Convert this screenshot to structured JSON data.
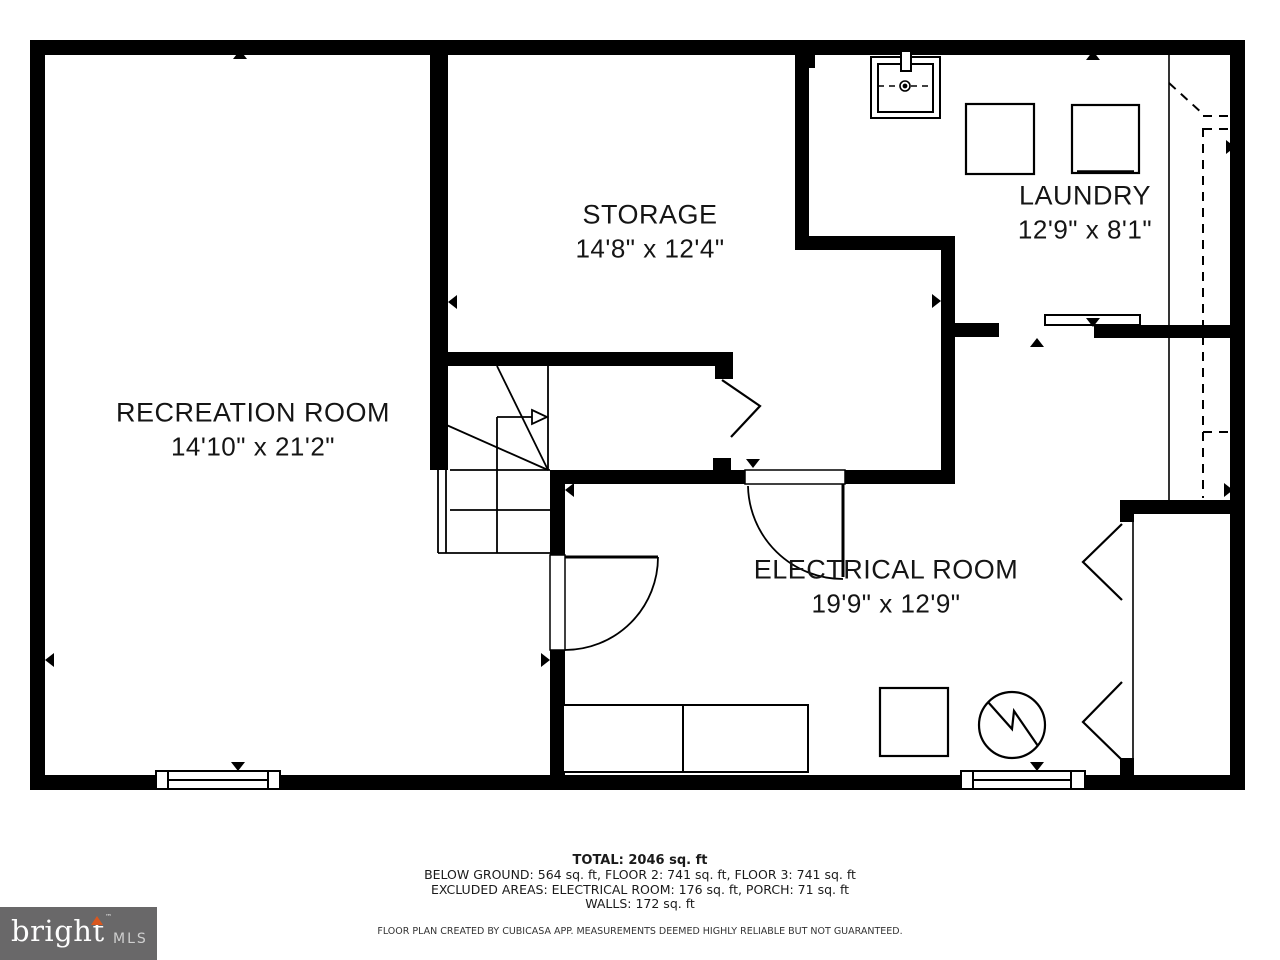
{
  "plan": {
    "rooms": [
      {
        "name": "RECREATION ROOM",
        "dims": "14'10\" x 21'2\""
      },
      {
        "name": "STORAGE",
        "dims": "14'8\" x 12'4\""
      },
      {
        "name": "LAUNDRY",
        "dims": "12'9\" x 8'1\""
      },
      {
        "name": "ELECTRICAL ROOM",
        "dims": "19'9\" x 12'9\""
      }
    ],
    "fixtures": [
      "sink",
      "washer",
      "dryer",
      "water-heater",
      "electrical-panel",
      "counter",
      "stairs"
    ]
  },
  "summary": {
    "total": "TOTAL: 2046 sq. ft",
    "line1": "BELOW GROUND: 564 sq. ft, FLOOR 2: 741 sq. ft, FLOOR 3: 741 sq. ft",
    "line2": "EXCLUDED AREAS: ELECTRICAL ROOM: 176 sq. ft, PORCH: 71 sq. ft",
    "line3": "WALLS: 172 sq. ft"
  },
  "disclaimer": "FLOOR PLAN CREATED BY CUBICASA APP. MEASUREMENTS DEEMED HIGHLY RELIABLE BUT NOT GUARANTEED.",
  "logo": {
    "brand": "bright",
    "tm": "TM",
    "suffix": "MLS"
  },
  "colors": {
    "line": "#000000",
    "logo_bg": "#696869",
    "logo_accent": "#d9571f"
  }
}
